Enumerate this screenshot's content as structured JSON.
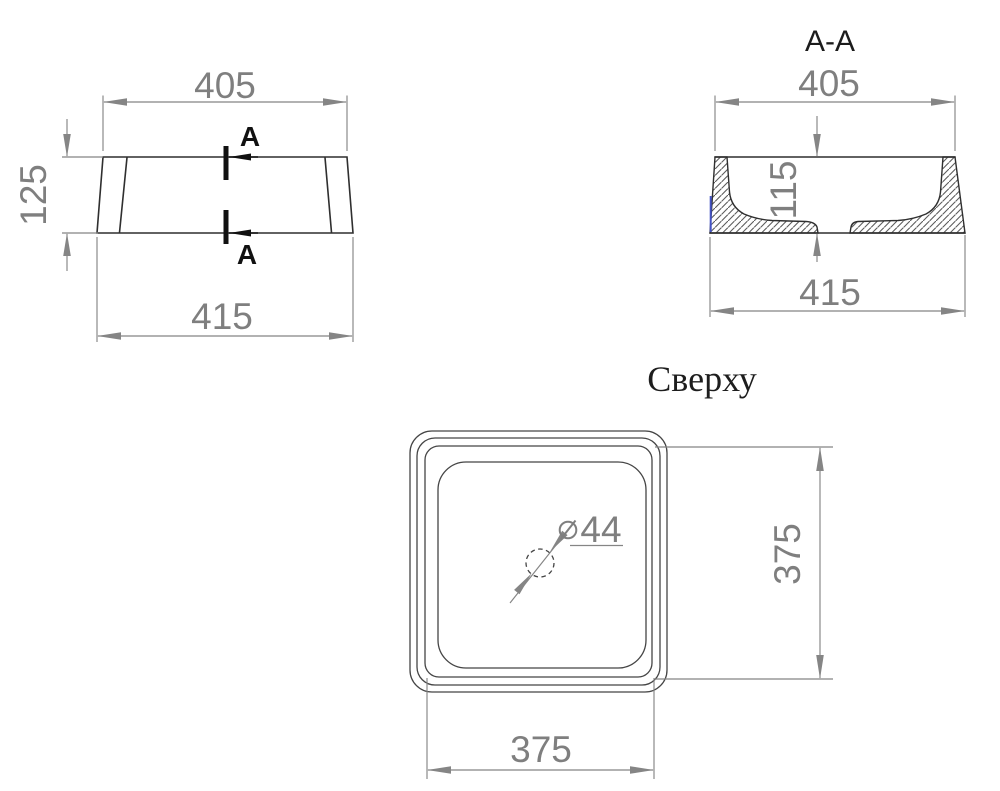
{
  "front_view": {
    "dim_top_width": "405",
    "dim_height": "125",
    "dim_bottom_width": "415",
    "section_mark": "A"
  },
  "section_view": {
    "title": "A-A",
    "dim_top_width": "405",
    "dim_depth": "115",
    "dim_bottom_width": "415"
  },
  "top_view": {
    "title": "Сверху",
    "dim_width": "375",
    "dim_height": "375",
    "drain_diameter": "44"
  },
  "colors": {
    "background": "#ffffff",
    "outline": "#2f2f2f",
    "dimension": "#7f7f7f",
    "accent_blue": "#4352c4"
  }
}
